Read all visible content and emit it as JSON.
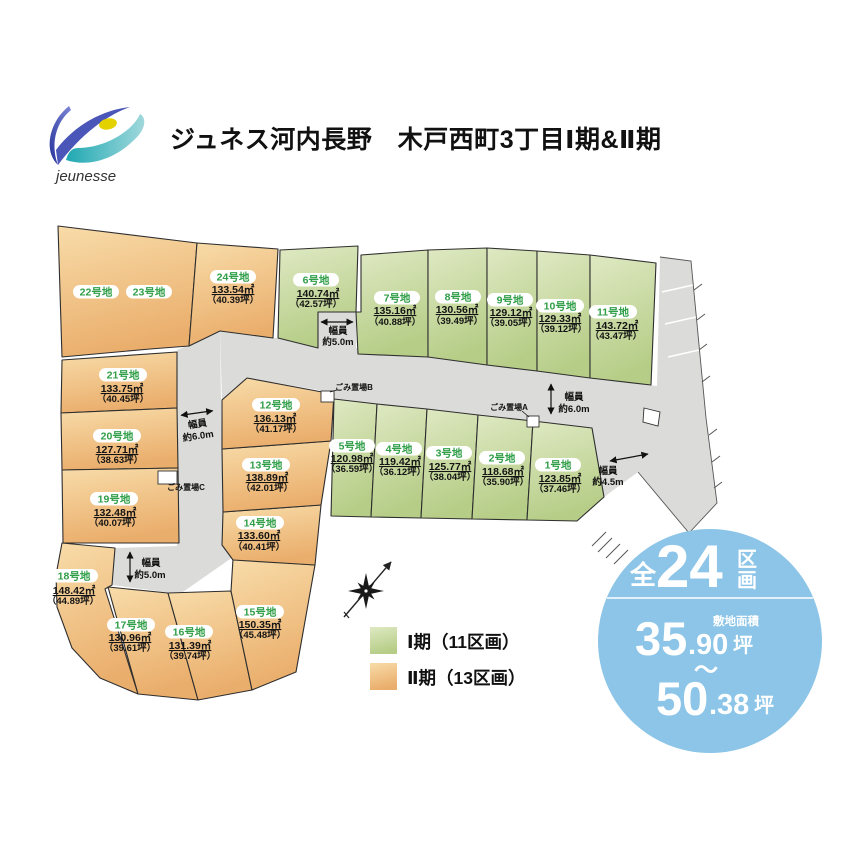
{
  "header": {
    "title": "ジュネス河内長野　木戸西町3丁目Ⅰ期&Ⅱ期",
    "logo_text": "jeunesse"
  },
  "legend": {
    "phase1_label": "Ⅰ期（11区画）",
    "phase2_label": "Ⅱ期（13区画）"
  },
  "badge": {
    "prefix": "全",
    "count": "24",
    "suffix_top": "区",
    "suffix_bottom": "画",
    "area_caption": "敷地面積",
    "min_int": "35",
    "min_dec": ".90",
    "min_unit": "坪",
    "tilde": "～",
    "max_int": "50",
    "max_dec": ".38",
    "max_unit": "坪"
  },
  "garbage": {
    "a": "ごみ置場A",
    "b": "ごみ置場B",
    "c": "ごみ置場C"
  },
  "road_labels": {
    "stub_top": {
      "l1": "幅員",
      "l2": "約5.0m"
    },
    "west_road": {
      "l1": "幅員",
      "l2": "約6.0m"
    },
    "stub_southwest": {
      "l1": "幅員",
      "l2": "約5.0m"
    },
    "main_road": {
      "l1": "幅員",
      "l2": "約6.0m"
    },
    "east_road": {
      "l1": "幅員",
      "l2": "約4.5m"
    }
  },
  "colors": {
    "phase1_green": "#C7DA9B",
    "phase2_orange": "#F0C183",
    "road_gray": "#DBDBD9",
    "badge_blue": "#8CC5E8",
    "label_green": "#2F9E47"
  },
  "plots": [
    {
      "name": "1号地",
      "area": "123.85㎡",
      "tsubo": "（37.46坪）",
      "phase": "Ⅰ期"
    },
    {
      "name": "2号地",
      "area": "118.68㎡",
      "tsubo": "（35.90坪）",
      "phase": "Ⅰ期"
    },
    {
      "name": "3号地",
      "area": "125.77㎡",
      "tsubo": "（38.04坪）",
      "phase": "Ⅰ期"
    },
    {
      "name": "4号地",
      "area": "119.42㎡",
      "tsubo": "（36.12坪）",
      "phase": "Ⅰ期"
    },
    {
      "name": "5号地",
      "area": "120.98㎡",
      "tsubo": "（36.59坪）",
      "phase": "Ⅰ期"
    },
    {
      "name": "6号地",
      "area": "140.74㎡",
      "tsubo": "（42.57坪）",
      "phase": "Ⅰ期"
    },
    {
      "name": "7号地",
      "area": "135.16㎡",
      "tsubo": "（40.88坪）",
      "phase": "Ⅰ期"
    },
    {
      "name": "8号地",
      "area": "130.56㎡",
      "tsubo": "（39.49坪）",
      "phase": "Ⅰ期"
    },
    {
      "name": "9号地",
      "area": "129.12㎡",
      "tsubo": "（39.05坪）",
      "phase": "Ⅰ期"
    },
    {
      "name": "10号地",
      "area": "129.33㎡",
      "tsubo": "（39.12坪）",
      "phase": "Ⅰ期"
    },
    {
      "name": "11号地",
      "area": "143.72㎡",
      "tsubo": "（43.47坪）",
      "phase": "Ⅰ期"
    },
    {
      "name": "12号地",
      "area": "136.13㎡",
      "tsubo": "（41.17坪）",
      "phase": "Ⅱ期"
    },
    {
      "name": "13号地",
      "area": "138.89㎡",
      "tsubo": "（42.01坪）",
      "phase": "Ⅱ期"
    },
    {
      "name": "14号地",
      "area": "133.60㎡",
      "tsubo": "（40.41坪）",
      "phase": "Ⅱ期"
    },
    {
      "name": "15号地",
      "area": "150.35㎡",
      "tsubo": "（45.48坪）",
      "phase": "Ⅱ期"
    },
    {
      "name": "16号地",
      "area": "131.39㎡",
      "tsubo": "（39.74坪）",
      "phase": "Ⅱ期"
    },
    {
      "name": "17号地",
      "area": "130.96㎡",
      "tsubo": "（39.61坪）",
      "phase": "Ⅱ期"
    },
    {
      "name": "18号地",
      "area": "148.42㎡",
      "tsubo": "（44.89坪）",
      "phase": "Ⅱ期"
    },
    {
      "name": "19号地",
      "area": "132.48㎡",
      "tsubo": "（40.07坪）",
      "phase": "Ⅱ期"
    },
    {
      "name": "20号地",
      "area": "127.71㎡",
      "tsubo": "（38.63坪）",
      "phase": "Ⅱ期"
    },
    {
      "name": "21号地",
      "area": "133.75㎡",
      "tsubo": "（40.45坪）",
      "phase": "Ⅱ期"
    },
    {
      "name": "22号地",
      "area": "",
      "tsubo": "",
      "phase": "Ⅱ期"
    },
    {
      "name": "23号地",
      "area": "",
      "tsubo": "",
      "phase": "Ⅱ期"
    },
    {
      "name": "24号地",
      "area": "133.54㎡",
      "tsubo": "（40.39坪）",
      "phase": "Ⅱ期"
    }
  ]
}
